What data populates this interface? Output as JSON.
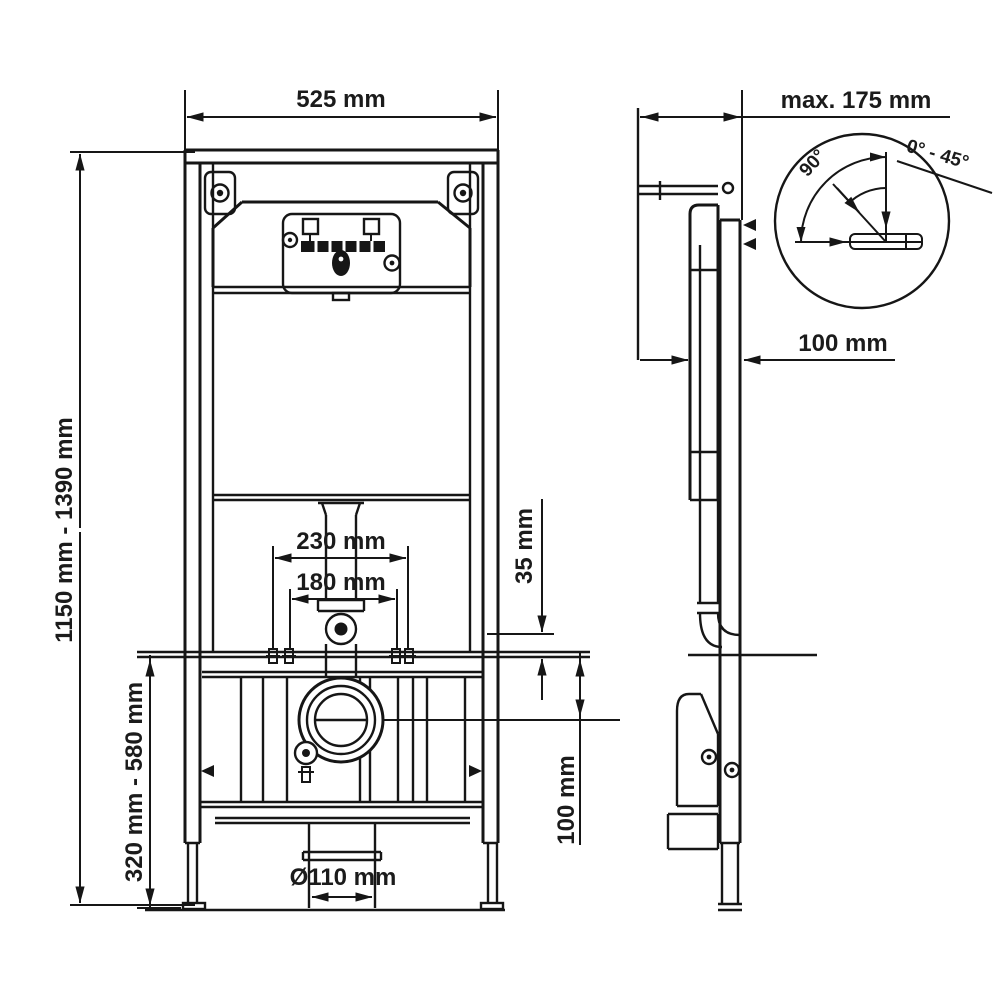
{
  "labels": {
    "front_width": "525 mm",
    "frame_height": "1150 mm - 1390 mm",
    "fix_outer": "230 mm",
    "fix_inner": "180 mm",
    "offset_35": "35 mm",
    "rail_100": "100 mm",
    "leg_range": "320 mm - 580 mm",
    "drain_diameter": "Ø110 mm",
    "depth_max": "max. 175 mm",
    "profile_100": "100 mm",
    "angle_90": "90°",
    "angle_range": "0° - 45°"
  },
  "colors": {
    "line": "#161616",
    "background": "#ffffff"
  }
}
